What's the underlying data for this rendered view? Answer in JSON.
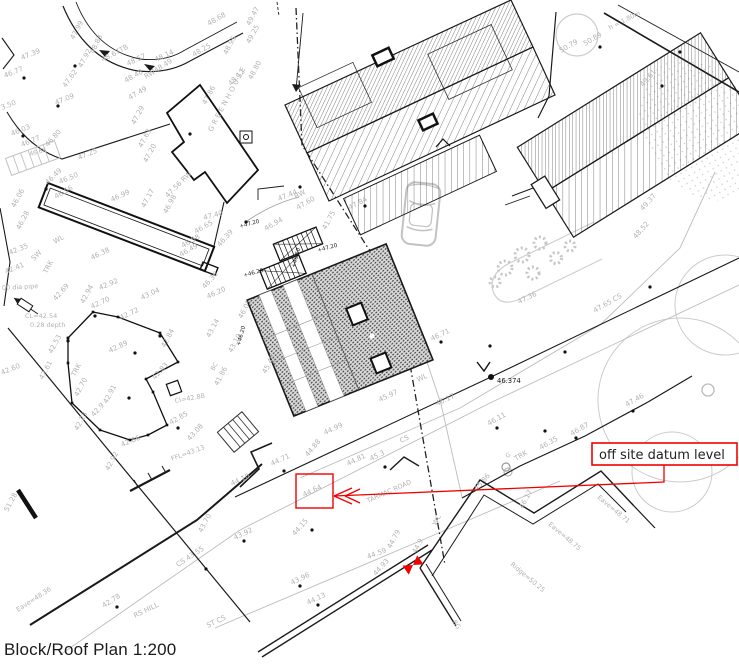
{
  "title": {
    "caption": "Block/Roof Plan 1:200"
  },
  "annotation": {
    "label": "off site datum level",
    "highlighted_level": "44.64",
    "color": "#f20000"
  },
  "datum": {
    "value": "46.374"
  },
  "colors": {
    "ink": "#1a1a1a",
    "survey_gray": "#b2b2b2",
    "annotation_red": "#f20000",
    "vegetation_gray": "#c9c9c9"
  },
  "building_names": {
    "greenhouse": "GREENHOUSE"
  },
  "road_names": {
    "tarmac_road": "TARMAC ROAD",
    "hill_street": "RS HILL"
  },
  "roof_levels": {
    "eave_1": "Eave=48.71",
    "eave_2": "Eave=48.75",
    "ridge": "Ridge=50.25",
    "eave_3": "Eave=48.36"
  },
  "labels": [
    {
      "t": "47.39",
      "x": 22,
      "y": 60,
      "r": -22
    },
    {
      "t": "46.77",
      "x": 5,
      "y": 78,
      "r": -22
    },
    {
      "t": "47.62",
      "x": 66,
      "y": 88,
      "r": -55
    },
    {
      "t": "47.09",
      "x": 56,
      "y": 105,
      "r": -22
    },
    {
      "t": "3.50",
      "x": 2,
      "y": 110,
      "r": -22
    },
    {
      "t": "47.99",
      "x": 74,
      "y": 40,
      "r": -62
    },
    {
      "t": "47.92",
      "x": 82,
      "y": 68,
      "r": -62
    },
    {
      "t": "48.83",
      "x": 94,
      "y": 54,
      "r": -65
    },
    {
      "t": "48.67TB",
      "x": 103,
      "y": 62,
      "r": -28
    },
    {
      "t": "48.57",
      "x": 128,
      "y": 66,
      "r": -25
    },
    {
      "t": "48.14",
      "x": 156,
      "y": 62,
      "r": -25
    },
    {
      "t": "48.48",
      "x": 126,
      "y": 83,
      "r": -30
    },
    {
      "t": "RW48.49",
      "x": 146,
      "y": 79,
      "r": -32
    },
    {
      "t": "48.68",
      "x": 209,
      "y": 26,
      "r": -30
    },
    {
      "t": "48.25",
      "x": 194,
      "y": 57,
      "r": -30
    },
    {
      "t": "48.95",
      "x": 227,
      "y": 55,
      "r": -62
    },
    {
      "t": "48.12",
      "x": 231,
      "y": 86,
      "r": -45
    },
    {
      "t": "49.47",
      "x": 250,
      "y": 26,
      "r": -62
    },
    {
      "t": "49.25",
      "x": 250,
      "y": 44,
      "r": -62
    },
    {
      "t": "48.80",
      "x": 252,
      "y": 80,
      "r": -62
    },
    {
      "t": "47.86",
      "x": 206,
      "y": 105,
      "r": -62
    },
    {
      "t": "GREENHOUSE",
      "x": 212,
      "y": 132,
      "r": -62,
      "s": 7,
      "ls": 2.5
    },
    {
      "t": "47.49",
      "x": 130,
      "y": 100,
      "r": -30
    },
    {
      "t": "47.29",
      "x": 135,
      "y": 125,
      "r": -62
    },
    {
      "t": "47.63",
      "x": 142,
      "y": 148,
      "r": -62
    },
    {
      "t": "47.20",
      "x": 147,
      "y": 163,
      "r": -62
    },
    {
      "t": "47.25",
      "x": 79,
      "y": 160,
      "r": -22
    },
    {
      "t": "46.03",
      "x": 12,
      "y": 136,
      "r": -22
    },
    {
      "t": "46.77",
      "x": 22,
      "y": 147,
      "r": -22
    },
    {
      "t": "46.80",
      "x": 48,
      "y": 147,
      "r": -48
    },
    {
      "t": "46.68",
      "x": 30,
      "y": 156,
      "r": -15,
      "s": 6
    },
    {
      "t": "47.17",
      "x": 145,
      "y": 208,
      "r": -62
    },
    {
      "t": "47.56 RW",
      "x": 168,
      "y": 198,
      "r": -45
    },
    {
      "t": "46.98",
      "x": 167,
      "y": 214,
      "r": -62
    },
    {
      "t": "47.40",
      "x": 204,
      "y": 220,
      "r": -15
    },
    {
      "t": "47.44",
      "x": 279,
      "y": 201,
      "r": -22
    },
    {
      "t": "46.65",
      "x": 196,
      "y": 234,
      "r": -30
    },
    {
      "t": "46.58",
      "x": 183,
      "y": 248,
      "r": -30
    },
    {
      "t": "46.49",
      "x": 181,
      "y": 257,
      "r": -30
    },
    {
      "t": "46.39",
      "x": 220,
      "y": 247,
      "r": -48
    },
    {
      "t": "46.49",
      "x": 48,
      "y": 185,
      "r": -45
    },
    {
      "t": "46.50",
      "x": 60,
      "y": 184,
      "r": -22
    },
    {
      "t": "46.56",
      "x": 56,
      "y": 199,
      "r": -30
    },
    {
      "t": "46.99",
      "x": 112,
      "y": 202,
      "r": -25
    },
    {
      "t": "46.06",
      "x": 15,
      "y": 208,
      "r": -62
    },
    {
      "t": "46.28",
      "x": 20,
      "y": 230,
      "r": -62
    },
    {
      "t": "WL",
      "x": 55,
      "y": 244,
      "r": -30
    },
    {
      "t": "46.38",
      "x": 92,
      "y": 260,
      "r": -25
    },
    {
      "t": "SW",
      "x": 34,
      "y": 261,
      "r": -45
    },
    {
      "t": "TRK",
      "x": 47,
      "y": 274,
      "r": -62
    },
    {
      "t": "42.35",
      "x": 10,
      "y": 255,
      "r": -22
    },
    {
      "t": "42.41",
      "x": 6,
      "y": 274,
      "r": -22
    },
    {
      "t": "42.92",
      "x": 100,
      "y": 290,
      "r": -22
    },
    {
      "t": "42.94",
      "x": 84,
      "y": 304,
      "r": -62
    },
    {
      "t": "42.69",
      "x": 56,
      "y": 301,
      "r": -48
    },
    {
      "t": "43.04",
      "x": 142,
      "y": 300,
      "r": -25
    },
    {
      "t": "46.36",
      "x": 205,
      "y": 289,
      "r": -48
    },
    {
      "t": "46.20",
      "x": 208,
      "y": 299,
      "r": -25
    },
    {
      "t": "00 dia pipe",
      "x": 2,
      "y": 290,
      "r": -3,
      "s": 6.5
    },
    {
      "t": "CL=42.54",
      "x": 25,
      "y": 318,
      "r": 0,
      "s": 6.5
    },
    {
      "t": "0.28 depth",
      "x": 30,
      "y": 327,
      "r": 0,
      "s": 6.5
    },
    {
      "t": "42.60",
      "x": 2,
      "y": 375,
      "r": -22
    },
    {
      "t": "42.53",
      "x": 52,
      "y": 354,
      "r": -62
    },
    {
      "t": "42.61",
      "x": 43,
      "y": 380,
      "r": -62
    },
    {
      "t": "TRK",
      "x": 75,
      "y": 377,
      "r": -62
    },
    {
      "t": "42.70",
      "x": 78,
      "y": 397,
      "r": -62
    },
    {
      "t": "42.23",
      "x": 78,
      "y": 431,
      "r": -62
    },
    {
      "t": "42.9",
      "x": 94,
      "y": 417,
      "r": -48
    },
    {
      "t": "42.92",
      "x": 109,
      "y": 471,
      "r": -62
    },
    {
      "t": "42.86",
      "x": 122,
      "y": 447,
      "r": -22
    },
    {
      "t": "42.91",
      "x": 107,
      "y": 404,
      "r": -62
    },
    {
      "t": "42.89",
      "x": 110,
      "y": 353,
      "r": -25
    },
    {
      "t": "42.70",
      "x": 92,
      "y": 309,
      "r": -25
    },
    {
      "t": "42.72",
      "x": 121,
      "y": 320,
      "r": -25
    },
    {
      "t": "42.84",
      "x": 165,
      "y": 348,
      "r": -62
    },
    {
      "t": "42.83",
      "x": 155,
      "y": 380,
      "r": -48
    },
    {
      "t": "CI=42.88",
      "x": 175,
      "y": 403,
      "r": -10,
      "s": 6.5
    },
    {
      "t": "42.85",
      "x": 171,
      "y": 425,
      "r": -30
    },
    {
      "t": "43.08",
      "x": 190,
      "y": 441,
      "r": -48
    },
    {
      "t": "FFL=43.13",
      "x": 172,
      "y": 461,
      "r": -20,
      "s": 6.5
    },
    {
      "t": "43.14",
      "x": 210,
      "y": 338,
      "r": -62
    },
    {
      "t": "43.10",
      "x": 232,
      "y": 353,
      "r": -62
    },
    {
      "t": "BC",
      "x": 214,
      "y": 371,
      "r": -62,
      "s": 6
    },
    {
      "t": "41.86",
      "x": 218,
      "y": 386,
      "r": -62
    },
    {
      "t": "46.94",
      "x": 266,
      "y": 231,
      "r": -30
    },
    {
      "t": "+47.20",
      "x": 240,
      "y": 228,
      "r": -15,
      "c": "k",
      "s": 5.5
    },
    {
      "t": "+47.20",
      "x": 318,
      "y": 252,
      "r": -15,
      "c": "k",
      "s": 5.5
    },
    {
      "t": "+46.50",
      "x": 295,
      "y": 268,
      "r": -75,
      "c": "k",
      "s": 5.5
    },
    {
      "t": "+46.20",
      "x": 244,
      "y": 277,
      "r": -15,
      "c": "k",
      "s": 5.5
    },
    {
      "t": "+46.20",
      "x": 240,
      "y": 346,
      "r": -75,
      "c": "k",
      "s": 5.5
    },
    {
      "t": "46.05",
      "x": 242,
      "y": 319,
      "r": -62
    },
    {
      "t": "45.49",
      "x": 266,
      "y": 374,
      "r": -62
    },
    {
      "t": "45.97",
      "x": 380,
      "y": 402,
      "r": -25
    },
    {
      "t": "WL",
      "x": 418,
      "y": 382,
      "r": -25
    },
    {
      "t": "RW",
      "x": 296,
      "y": 199,
      "r": -30
    },
    {
      "t": "47.60",
      "x": 298,
      "y": 210,
      "r": -30
    },
    {
      "t": "47.84",
      "x": 350,
      "y": 210,
      "r": -28
    },
    {
      "t": "41.75",
      "x": 326,
      "y": 230,
      "r": -62
    },
    {
      "t": "46.71",
      "x": 432,
      "y": 341,
      "r": -25
    },
    {
      "t": "46.17",
      "x": 437,
      "y": 406,
      "r": -25
    },
    {
      "t": "CS",
      "x": 401,
      "y": 443,
      "r": -25
    },
    {
      "t": "44.99",
      "x": 325,
      "y": 435,
      "r": -25
    },
    {
      "t": "44.88",
      "x": 308,
      "y": 457,
      "r": -50
    },
    {
      "t": "44.81",
      "x": 348,
      "y": 466,
      "r": -25
    },
    {
      "t": "45.3",
      "x": 371,
      "y": 461,
      "r": -25
    },
    {
      "t": "44.71",
      "x": 272,
      "y": 466,
      "r": -25
    },
    {
      "t": "44.64",
      "x": 304,
      "y": 497,
      "r": -25
    },
    {
      "t": "TARMAC ROAD",
      "x": 368,
      "y": 503,
      "r": -24,
      "s": 6.5
    },
    {
      "t": "44.10",
      "x": 232,
      "y": 486,
      "r": -25
    },
    {
      "t": "44.15",
      "x": 295,
      "y": 536,
      "r": -48
    },
    {
      "t": "43.70",
      "x": 202,
      "y": 533,
      "r": -62
    },
    {
      "t": "43.92",
      "x": 235,
      "y": 540,
      "r": -25
    },
    {
      "t": "CS 43.55",
      "x": 178,
      "y": 567,
      "r": -33
    },
    {
      "t": "42.78",
      "x": 104,
      "y": 608,
      "r": -33
    },
    {
      "t": "RS HILL",
      "x": 135,
      "y": 618,
      "r": -26,
      "s": 7
    },
    {
      "t": "ST CS",
      "x": 208,
      "y": 628,
      "r": -26
    },
    {
      "t": "43.96",
      "x": 292,
      "y": 585,
      "r": -25
    },
    {
      "t": "44.13",
      "x": 308,
      "y": 605,
      "r": -25
    },
    {
      "t": "Eave=48.36",
      "x": 18,
      "y": 612,
      "r": -33,
      "s": 6.5
    },
    {
      "t": "51.28",
      "x": 8,
      "y": 512,
      "r": -62
    },
    {
      "t": "49.37",
      "x": 643,
      "y": 211,
      "r": -48
    },
    {
      "t": "48.52",
      "x": 636,
      "y": 239,
      "r": -48
    },
    {
      "t": "47.36",
      "x": 519,
      "y": 304,
      "r": -25
    },
    {
      "t": "47.65 CS",
      "x": 595,
      "y": 313,
      "r": -30
    },
    {
      "t": "47.46",
      "x": 627,
      "y": 407,
      "r": -30
    },
    {
      "t": "46.87",
      "x": 572,
      "y": 436,
      "r": -30
    },
    {
      "t": "46.35",
      "x": 541,
      "y": 450,
      "r": -30
    },
    {
      "t": "46.11",
      "x": 489,
      "y": 426,
      "r": -30
    },
    {
      "t": "G",
      "x": 507,
      "y": 458,
      "r": -30,
      "s": 6
    },
    {
      "t": "TRK",
      "x": 516,
      "y": 461,
      "r": -30
    },
    {
      "t": "44.59",
      "x": 368,
      "y": 559,
      "r": -20
    },
    {
      "t": "44.79",
      "x": 391,
      "y": 549,
      "r": -62
    },
    {
      "t": "44.9",
      "x": 416,
      "y": 554,
      "r": -62
    },
    {
      "t": "44.93",
      "x": 376,
      "y": 576,
      "r": -48
    },
    {
      "t": "WL",
      "x": 436,
      "y": 526,
      "r": -62
    },
    {
      "t": "46.17",
      "x": 523,
      "y": 509,
      "r": -62
    },
    {
      "t": "45.86",
      "x": 477,
      "y": 491,
      "r": -48
    },
    {
      "t": "Eave=48.71",
      "x": 597,
      "y": 498,
      "r": 40,
      "s": 6.5
    },
    {
      "t": "Eave=48.75",
      "x": 548,
      "y": 525,
      "r": 40,
      "s": 6.5
    },
    {
      "t": "Ridge=50.25",
      "x": 510,
      "y": 565,
      "r": 40,
      "s": 6.5
    },
    {
      "t": "BG",
      "x": 452,
      "y": 622,
      "r": 55,
      "s": 6.5
    },
    {
      "t": "50.79",
      "x": 561,
      "y": 53,
      "r": -30
    },
    {
      "t": "50.89",
      "x": 585,
      "y": 46,
      "r": -30
    },
    {
      "t": "h = 1.80m",
      "x": 610,
      "y": 30,
      "r": -27,
      "s": 6.5
    },
    {
      "t": "49.61",
      "x": 643,
      "y": 87,
      "r": -48
    },
    {
      "t": "46.374",
      "x": 497,
      "y": 383,
      "r": 0,
      "c": "k",
      "s": 6.8
    }
  ]
}
